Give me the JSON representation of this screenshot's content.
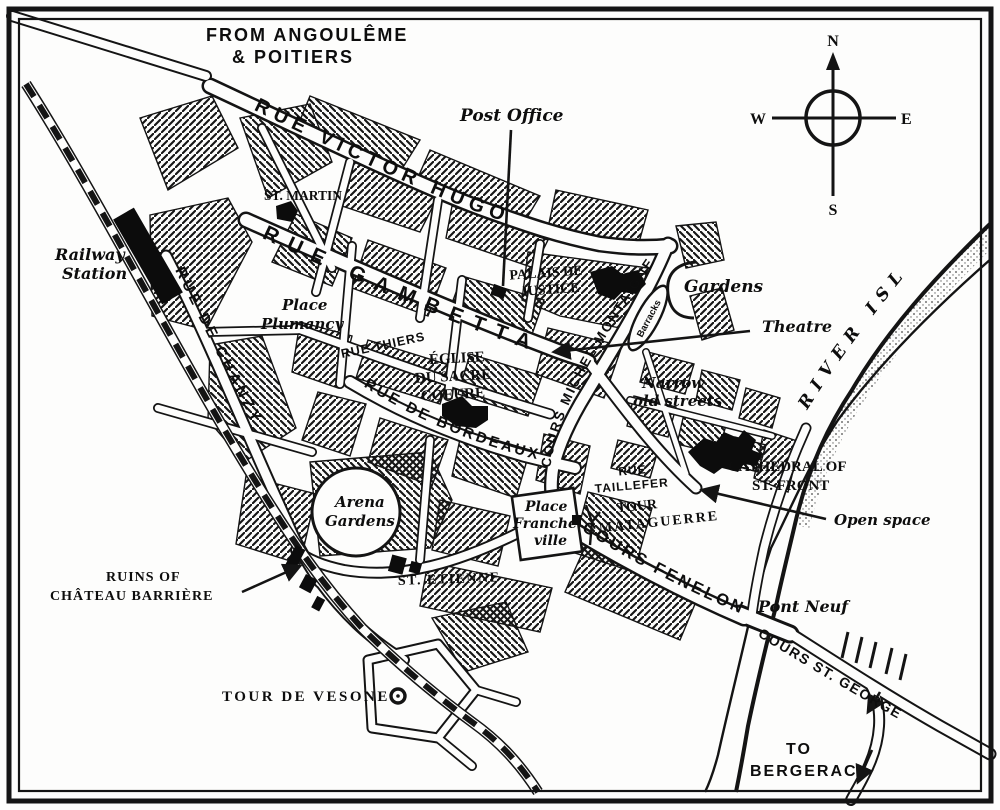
{
  "map": {
    "route_note": {
      "line1": "FROM ANGOULÊME",
      "line2": "& POITIERS"
    },
    "to_note": {
      "line1": "TO",
      "line2": "BERGERAC"
    },
    "compass": {
      "n": "N",
      "s": "S",
      "e": "E",
      "w": "W"
    },
    "river_label": "RIVER ISLE",
    "streets": {
      "rue_victor_hugo": "RUE VICTOR HUGO",
      "rue_gambetta": "RUE GAMBETTA",
      "rue_de_chanzy": "RUE DE CHANZY",
      "rue_thiers": "RUE THIERS",
      "rue_de_bordeaux": "RUE DE BORDEAUX",
      "cours_michel_montaigne": "COURS MICHEL MONTAIGNE",
      "rue_taillefer": {
        "line1": "RUE",
        "line2": "TAILLEFER"
      },
      "cours_fenelon": "COURS FENELON",
      "cours_st_georges": "COURS ST. GEORGES"
    },
    "places": {
      "post_office": "Post Office",
      "railway_station": {
        "line1": "Railway",
        "line2": "Station"
      },
      "st_martin": "ST. MARTIN",
      "place_plumancy": {
        "line1": "Place",
        "line2": "Plumancy"
      },
      "palais_de_justice": {
        "line1": "PALAIS DE",
        "line2": "JUSTICE"
      },
      "gardens": "Gardens",
      "theatre": "Theatre",
      "barracks": "Barracks",
      "eglise_sacre_coeur": {
        "line1": "ÉGLISE",
        "line2": "DU SACRÉ",
        "line3": "COEURE"
      },
      "narrow_old_streets": {
        "line1": "Narrow",
        "line2": "old streets"
      },
      "cathedral": {
        "line1": "CATHEDRAL OF",
        "line2": "ST. FRONT"
      },
      "open_space": "Open space",
      "tour_mataguerre": {
        "line1": "TOUR",
        "line2": "MATAGUERRE"
      },
      "pont_neuf": "Pont Neuf",
      "ruins_chateau": {
        "line1": "RUINS OF",
        "line2": "CHÂTEAU BARRIÈRE"
      },
      "st_etienne": "ST. ETIENNE",
      "arena_gardens": {
        "line1": "Arena",
        "line2": "Gardens"
      },
      "place_francheville": {
        "line1": "Place",
        "line2": "Franche",
        "line3": "ville"
      },
      "tour_de_vesone": "TOUR DE VESONE"
    },
    "colors": {
      "ink": "#141414",
      "paper": "#fdfdfc"
    }
  }
}
